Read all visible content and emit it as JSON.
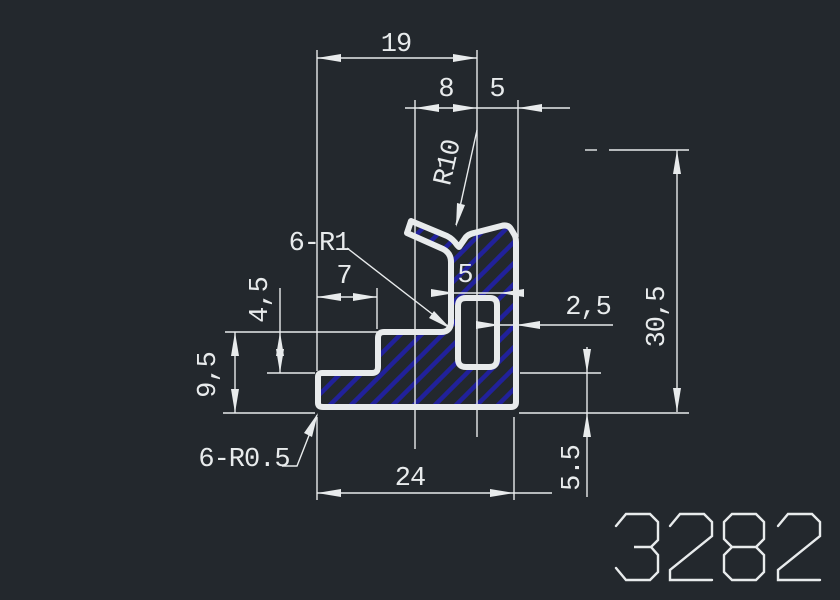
{
  "window": {
    "background": "#23282d"
  },
  "drawing": {
    "line_color": "#e8ebec",
    "hatch_color": "#21219b",
    "part_number": "3282",
    "dimensions": {
      "top_width": "19",
      "head_offset": "8",
      "head_side": "5",
      "radius_callout": "R10",
      "fillet_callout": "6-R1",
      "step_width": "7",
      "channel_width": "5",
      "wall_thickness": "2,5",
      "shelf_height": "4,5",
      "left_height": "9,5",
      "total_height": "30,5",
      "base_right_height": "5.5",
      "base_width": "24",
      "corner_callout": "6-R0.5"
    }
  }
}
